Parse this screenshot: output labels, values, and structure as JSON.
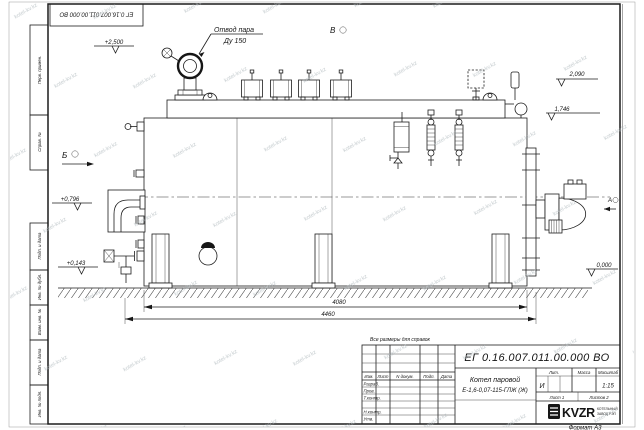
{
  "watermark": {
    "text": "kotel-kv.kz"
  },
  "frame": {
    "top_ref": "ЕГ 0.16.007.011.00.000 ВО",
    "left_boxes": [
      "Перв. примен.",
      "Справ. №",
      "Подп. и дата",
      "Инв. № дубл.",
      "Взам. инв. №",
      "Подп. и дата",
      "Инв. № подл."
    ]
  },
  "drawing": {
    "callout": {
      "line1": "Отвод пара",
      "line2": "Ду 150"
    },
    "views": {
      "b": "Б",
      "v": "В",
      "a": "А"
    },
    "elevations": {
      "e2500": "+2,500",
      "e2090": "2,090",
      "e1746": "1,746",
      "e0796": "+0,796",
      "e0143": "+0,143",
      "e0000": "0,000"
    },
    "dims": {
      "d4080": "4080",
      "d4460": "4460"
    }
  },
  "note": "Все размеры для справок",
  "title_block": {
    "doc_number": "ЕГ 0.16.007.011.00.000  ВО",
    "product_line1": "Котел паровой",
    "product_line2": "Е-1,6-0,07-115-ГЛЖ (Ж)",
    "cols": {
      "izm": "Изм.",
      "list": "Лист",
      "doc": "N докум.",
      "podp": "Подп.",
      "data": "Дата"
    },
    "rows": {
      "razrab": "Разраб.",
      "prov": "Пров.",
      "tkontr": "Т.контр.",
      "nkontr": "Н.контр.",
      "utv": "Утв."
    },
    "lit_header": "Лит.",
    "mass_header": "Масса",
    "scale_header": "Масштаб",
    "lit_value": "И",
    "scale_value": "1:15",
    "sheet": "Лист 1",
    "sheets": "Листов 2",
    "company": "KVZR",
    "company_line1": "КОТЕЛЬНЫЙ",
    "company_line2": "ЗАВОД РЭП",
    "format": "Формат А3"
  }
}
